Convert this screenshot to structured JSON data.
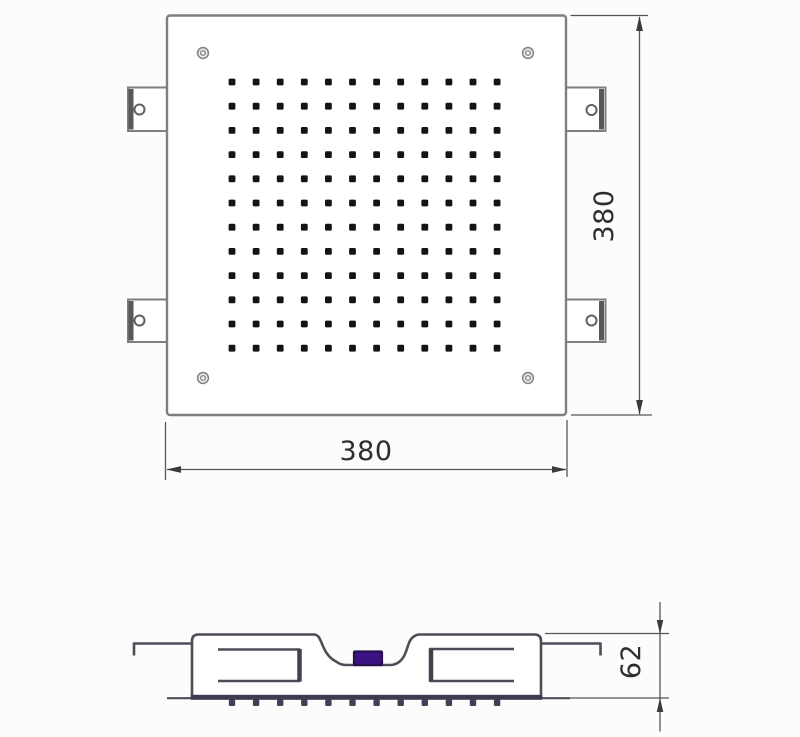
{
  "drawing": {
    "type": "technical-drawing",
    "subject": "square-ceiling-shower-head"
  },
  "colors": {
    "background": "#fcfcfc",
    "plate_line": "#7f7f7f",
    "tab_edge": "#585858",
    "section_line": "#504b57",
    "dim_line": "#555555",
    "arrow": "#3a3a3a",
    "text": "#2e2e2e",
    "hole": "#141414",
    "inlet_purple": "#3c1382",
    "inlet_border": "#27104d",
    "face_band": "#3f3a4f",
    "nozzle": "#433d58",
    "screw_ring": "#858585",
    "screw_fill": "#ededed"
  },
  "top_view": {
    "name": "top view",
    "width_dimension": "380",
    "height_dimension": "380",
    "spray_holes": {
      "rows": 12,
      "cols": 12
    },
    "corner_screw_count": 4,
    "mounting_tab_count": 4
  },
  "side_view": {
    "name": "side section view",
    "height_dimension": "62",
    "nozzle_count": 12
  }
}
